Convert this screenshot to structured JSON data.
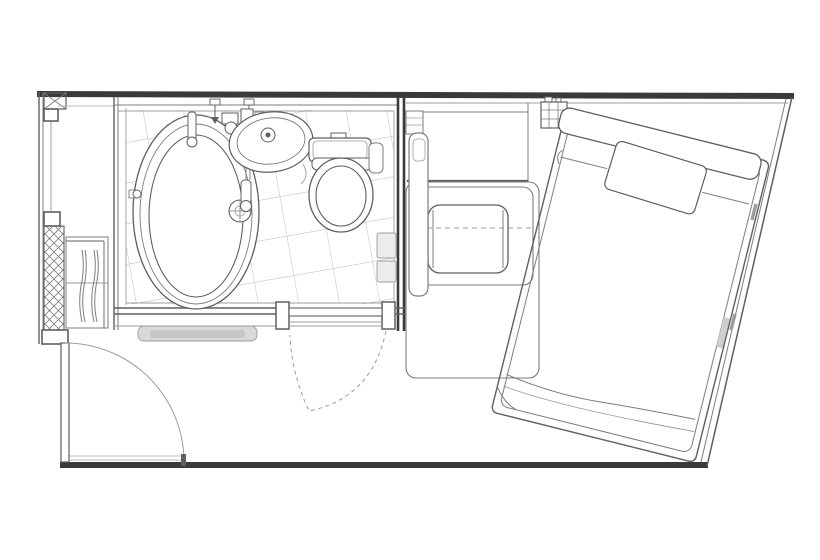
{
  "canvas": {
    "width": 820,
    "height": 560,
    "background": "#ffffff"
  },
  "colors": {
    "paper": "#ffffff",
    "wall": "#3a3a3a",
    "ink": "#5f5f5f",
    "mid": "#7d7d7d",
    "light": "#9d9d9d",
    "faint": "#bdbdbd",
    "tile": "#b9b9b9",
    "mat": "#d9d9d9",
    "matcore": "#c6c6c6",
    "panel": "#ececec",
    "rail": "#cfcfcf"
  },
  "scene": {
    "type": "hotel-guestroom-floor-plan",
    "rooms": [
      "entry",
      "unit-bathroom",
      "bedroom"
    ],
    "fixtures": [
      "bathtub",
      "washbasin",
      "toilet",
      "bathroom-door",
      "entrance-door",
      "closet",
      "tile-floor",
      "counter-strip",
      "desk",
      "table-rug",
      "chair",
      "nightstand-grid",
      "bed",
      "pillow",
      "headboard"
    ]
  }
}
